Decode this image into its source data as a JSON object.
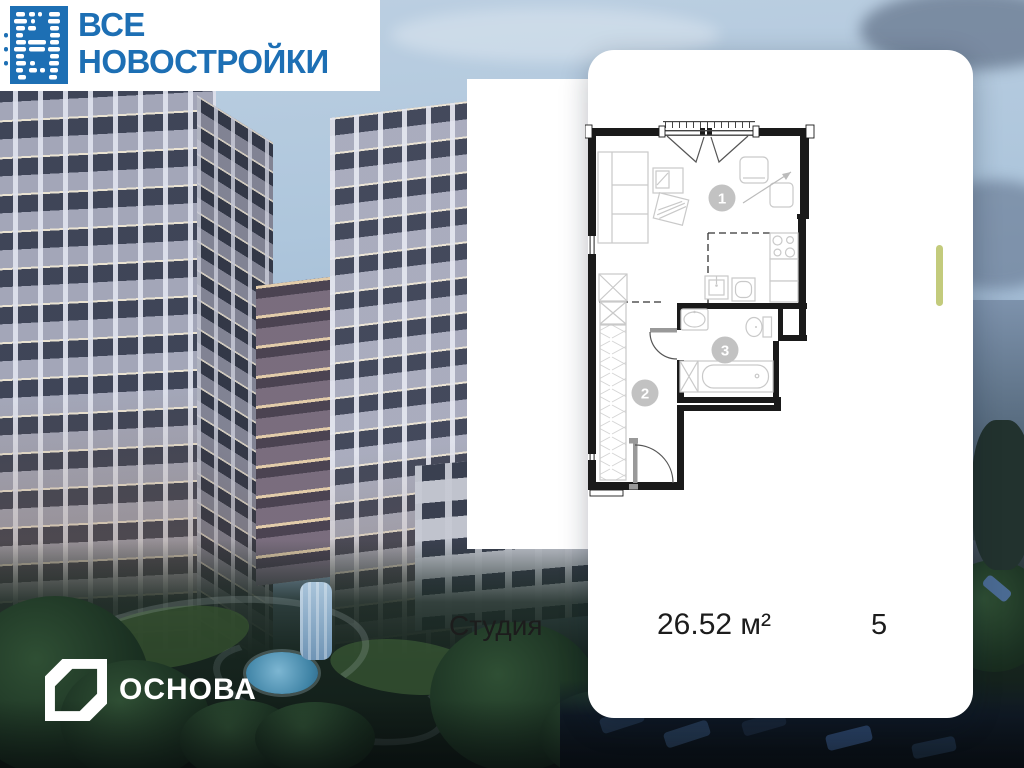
{
  "brand": {
    "line1": "ВСЕ",
    "line2": "НОВОСТРОЙКИ"
  },
  "listing": {
    "type_label": "Студия",
    "area": "26.52 м²",
    "floor": "5"
  },
  "plan": {
    "rooms": [
      {
        "number": "1"
      },
      {
        "number": "2"
      },
      {
        "number": "3"
      }
    ]
  },
  "developer": {
    "name": "ОСНОВА"
  },
  "colors": {
    "brand_blue": "#1d6fb4",
    "scroll_accent": "#c3cb7c",
    "plan_badge_gray": "#c2c2c2"
  }
}
